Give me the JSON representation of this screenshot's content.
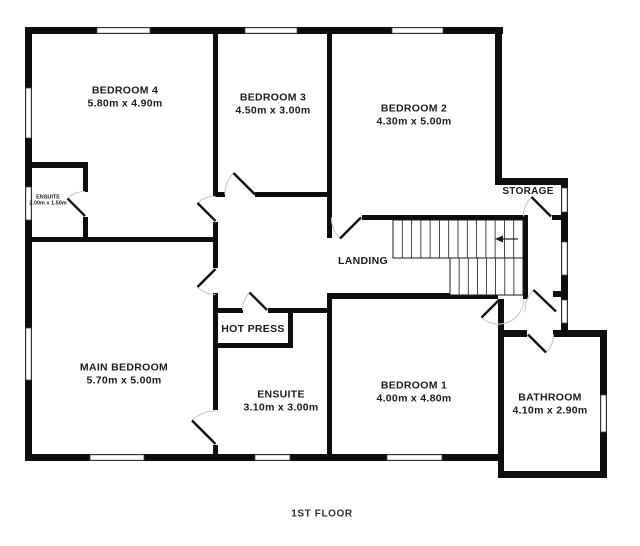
{
  "title": "1ST FLOOR",
  "floor_plan": {
    "rooms": [
      {
        "id": "bedroom-4",
        "name": "BEDROOM 4",
        "dims": "5.80m x 4.90m"
      },
      {
        "id": "bedroom-3",
        "name": "BEDROOM 3",
        "dims": "4.50m x 3.00m"
      },
      {
        "id": "bedroom-2",
        "name": "BEDROOM 2",
        "dims": "4.30m x 5.00m"
      },
      {
        "id": "storage",
        "name": "STORAGE",
        "dims": ""
      },
      {
        "id": "ensuite-small",
        "name": "ENSUITE",
        "dims": "2.00m x 1.50m"
      },
      {
        "id": "landing",
        "name": "LANDING",
        "dims": ""
      },
      {
        "id": "hot-press",
        "name": "HOT PRESS",
        "dims": ""
      },
      {
        "id": "main-bedroom",
        "name": "MAIN BEDROOM",
        "dims": "5.70m x 5.00m"
      },
      {
        "id": "ensuite-main",
        "name": "ENSUITE",
        "dims": "3.10m x 3.00m"
      },
      {
        "id": "bedroom-1",
        "name": "BEDROOM 1",
        "dims": "4.00m x 4.80m"
      },
      {
        "id": "bathroom",
        "name": "BATHROOM",
        "dims": "4.10m x 2.90m"
      }
    ],
    "stairs": {
      "direction": "left",
      "flights": 2
    },
    "colors": {
      "wall": "#0e0e0e",
      "background": "#ffffff",
      "door_arc": "#c8c8c8"
    }
  }
}
